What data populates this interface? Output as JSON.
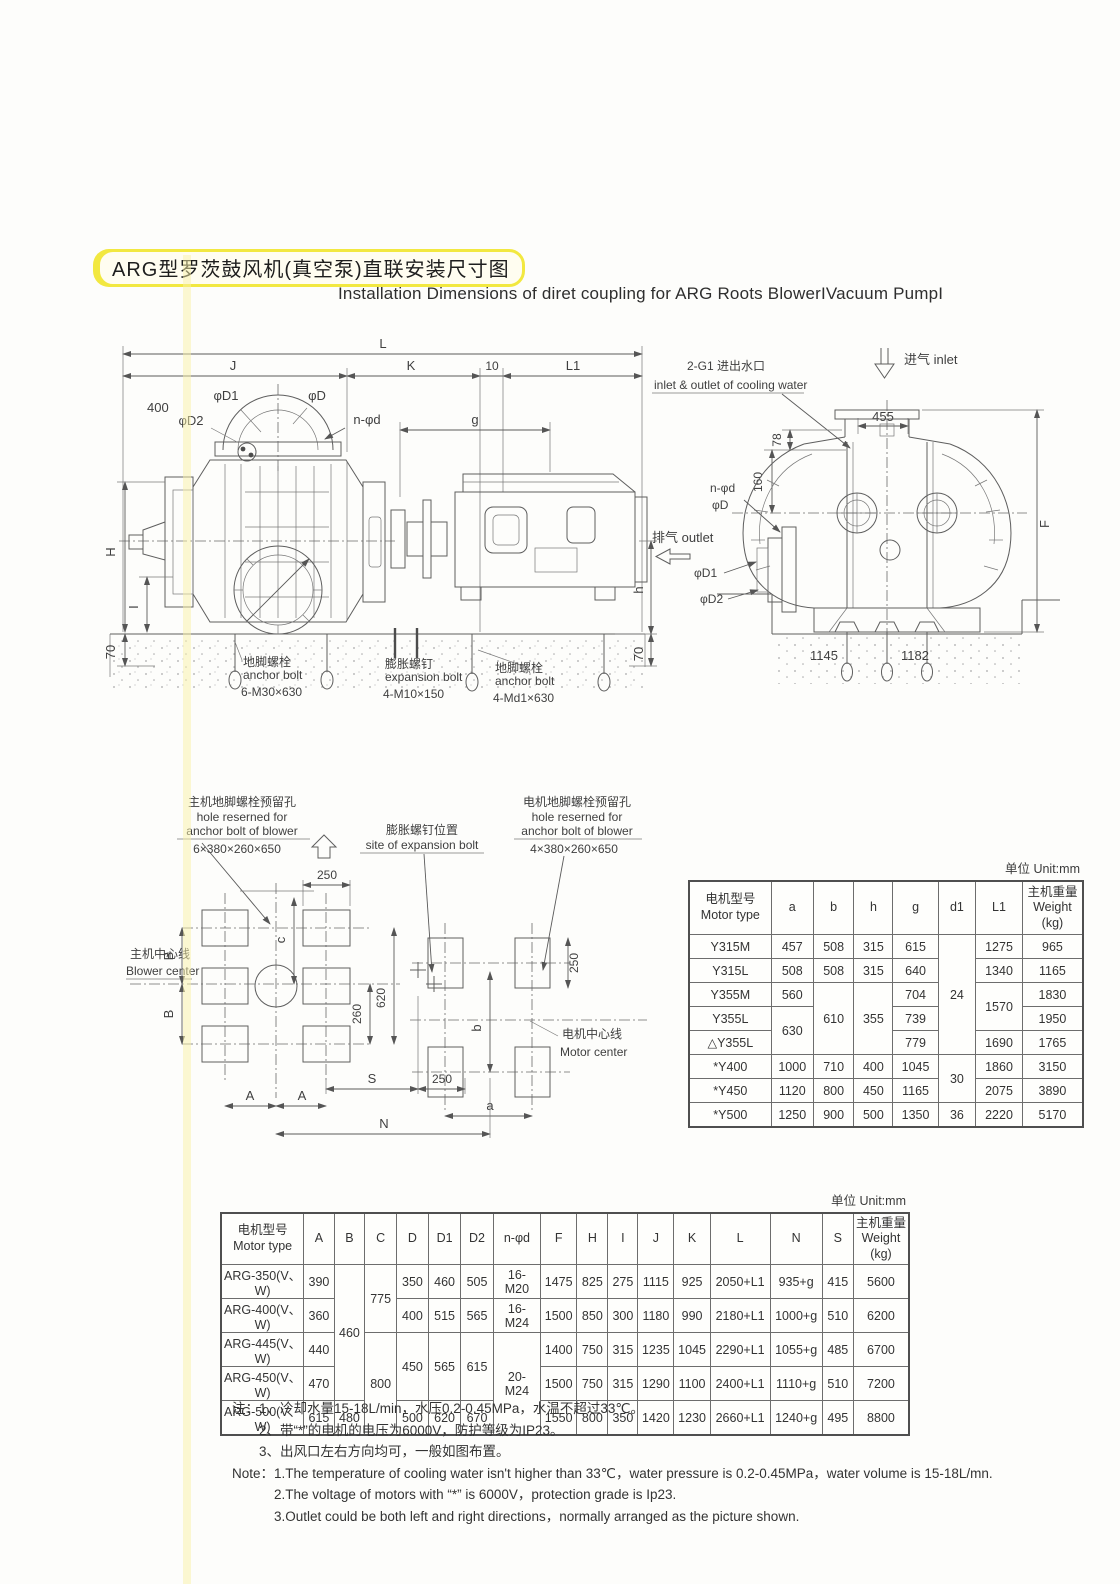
{
  "page": {
    "title_zh": "ARG型罗茨鼓风机(真空泵)直联安装尺寸图",
    "subtitle_en": "Installation Dimensions of diret coupling for ARG Roots BlowerIVacuum PumpI"
  },
  "drawing_side": {
    "dim_L": "L",
    "dim_J": "J",
    "dim_K": "K",
    "dim_10": "10",
    "dim_L1": "L1",
    "dim_400": "400",
    "phi_d1": "φD1",
    "phi_d": "φD",
    "phi_d2": "φD2",
    "n_phi_d": "n-φd",
    "dim_g": "g",
    "dim_H": "H",
    "dim_I": "I",
    "dim_70_left": "70",
    "dim_h": "h",
    "dim_70_right": "70",
    "callout1_zh": "地脚螺栓",
    "callout1_en": "anchor bolt",
    "callout1_spec": "6-M30×630",
    "callout2_zh": "膨胀螺钉",
    "callout2_en": "expansion bolt",
    "callout2_spec": "4-M10×150",
    "callout3_zh": "地脚螺栓",
    "callout3_en": "anchor bolt",
    "callout3_spec": "4-Md1×630"
  },
  "drawing_end": {
    "inlet": "进气  inlet",
    "cooling_zh": "2-G1  进出水口",
    "cooling_en": "inlet & outlet of cooling water",
    "dim_455": "455",
    "dim_78": "78",
    "dim_160": "160",
    "n_phi_d": "n-φd",
    "phi_d": "φD",
    "outlet": "排气  outlet",
    "phi_d1": "φD1",
    "phi_d2": "φD2",
    "dim_F": "F",
    "dim_1145": "1145",
    "dim_1182": "1182"
  },
  "foundation": {
    "blower_hole_zh": "主机地脚螺栓预留孔",
    "hole_en1": "hole reserned for",
    "hole_en2": "anchor bolt of blower",
    "blower_hole_spec": "6×380×260×650",
    "expansion_zh": "膨胀螺钉位置",
    "expansion_en": "site of expansion bolt",
    "motor_hole_zh": "电机地脚螺栓预留孔",
    "motor_hole_spec": "4×380×260×650",
    "blower_center_zh": "主机中心线",
    "blower_center_en": "Blower center",
    "motor_center_zh": "电机中心线",
    "motor_center_en": "Motor center",
    "dim_250_top": "250",
    "dim_c": "c",
    "dim_B1": "B",
    "dim_B2": "B",
    "dim_260": "260",
    "dim_620": "620",
    "dim_250_right": "250",
    "dim_S": "S",
    "dim_250_bottom": "250",
    "dim_A1": "A",
    "dim_A2": "A",
    "dim_b": "b",
    "dim_a": "a",
    "dim_N": "N"
  },
  "table1": {
    "unit_label": "单位 Unit:mm",
    "col_motor_zh": "电机型号",
    "col_motor_en": "Motor type",
    "cols": [
      "a",
      "b",
      "h",
      "g",
      "d1",
      "L1"
    ],
    "col_weight_zh": "主机重量",
    "col_weight_en": "Weight",
    "col_weight_kg": "(kg)",
    "rows": [
      [
        "Y315M",
        "457",
        "508",
        "315",
        "615",
        "24",
        "1275",
        "965"
      ],
      [
        "Y315L",
        "508",
        "508",
        "315",
        "640",
        "1340",
        "1165"
      ],
      [
        "Y355M",
        "560",
        "610",
        "355",
        "704",
        "1570",
        "1830"
      ],
      [
        "Y355L",
        "630",
        "739",
        "1950"
      ],
      [
        "△Y355L",
        "779",
        "1690",
        "1765"
      ],
      [
        "*Y400",
        "1000",
        "710",
        "400",
        "1045",
        "30",
        "1860",
        "3150"
      ],
      [
        "*Y450",
        "1120",
        "800",
        "450",
        "1165",
        "2075",
        "3890"
      ],
      [
        "*Y500",
        "1250",
        "900",
        "500",
        "1350",
        "36",
        "2220",
        "5170"
      ]
    ]
  },
  "table2": {
    "unit_label": "单位 Unit:mm",
    "col_motor_zh": "电机型号",
    "col_motor_en": "Motor type",
    "cols": [
      "A",
      "B",
      "C",
      "D",
      "D1",
      "D2",
      "n-φd",
      "F",
      "H",
      "I",
      "J",
      "K",
      "L",
      "N",
      "S"
    ],
    "col_weight_zh": "主机重量",
    "col_weight_en": "Weight",
    "col_weight_kg": "(kg)",
    "rows": [
      [
        "ARG-350(V、W)",
        "390",
        "460",
        "775",
        "350",
        "460",
        "505",
        "16-M20",
        "1475",
        "825",
        "275",
        "1115",
        "925",
        "2050+L1",
        "935+g",
        "415",
        "5600"
      ],
      [
        "ARG-400(V、W)",
        "360",
        "400",
        "515",
        "565",
        "16-M24",
        "1500",
        "850",
        "300",
        "1180",
        "990",
        "2180+L1",
        "1000+g",
        "510",
        "6200"
      ],
      [
        "ARG-445(V、W)",
        "440",
        "800",
        "450",
        "565",
        "615",
        "20-M24",
        "1400",
        "750",
        "315",
        "1235",
        "1045",
        "2290+L1",
        "1055+g",
        "485",
        "6700"
      ],
      [
        "ARG-450(V、W)",
        "470",
        "1500",
        "750",
        "315",
        "1290",
        "1100",
        "2400+L1",
        "1110+g",
        "510",
        "7200"
      ],
      [
        "ARG-500(V、W)",
        "615",
        "480",
        "500",
        "620",
        "670",
        "1550",
        "800",
        "350",
        "1420",
        "1230",
        "2660+L1",
        "1240+g",
        "495",
        "8800"
      ]
    ]
  },
  "notes": {
    "zh_label": "注：",
    "zh1": "1、冷却水量15-18L/min，水压0.2-0.45MPa，水温不超过33℃。",
    "zh2": "2、带“*”的电机的电压为6000V，防护等级为IP23。",
    "zh3": "3、出风口左右方向均可，一般如图布置。",
    "en_label": "Note：",
    "en1": "1.The temperature of cooling water isn't higher than 33℃，water pressure is 0.2-0.45MPa，water volume is 15-18L/mn.",
    "en2": "2.The voltage of motors with “*” is 6000V，protection grade is Ip23.",
    "en3": "3.Outlet could be both left and right directions，normally arranged as the picture shown."
  }
}
